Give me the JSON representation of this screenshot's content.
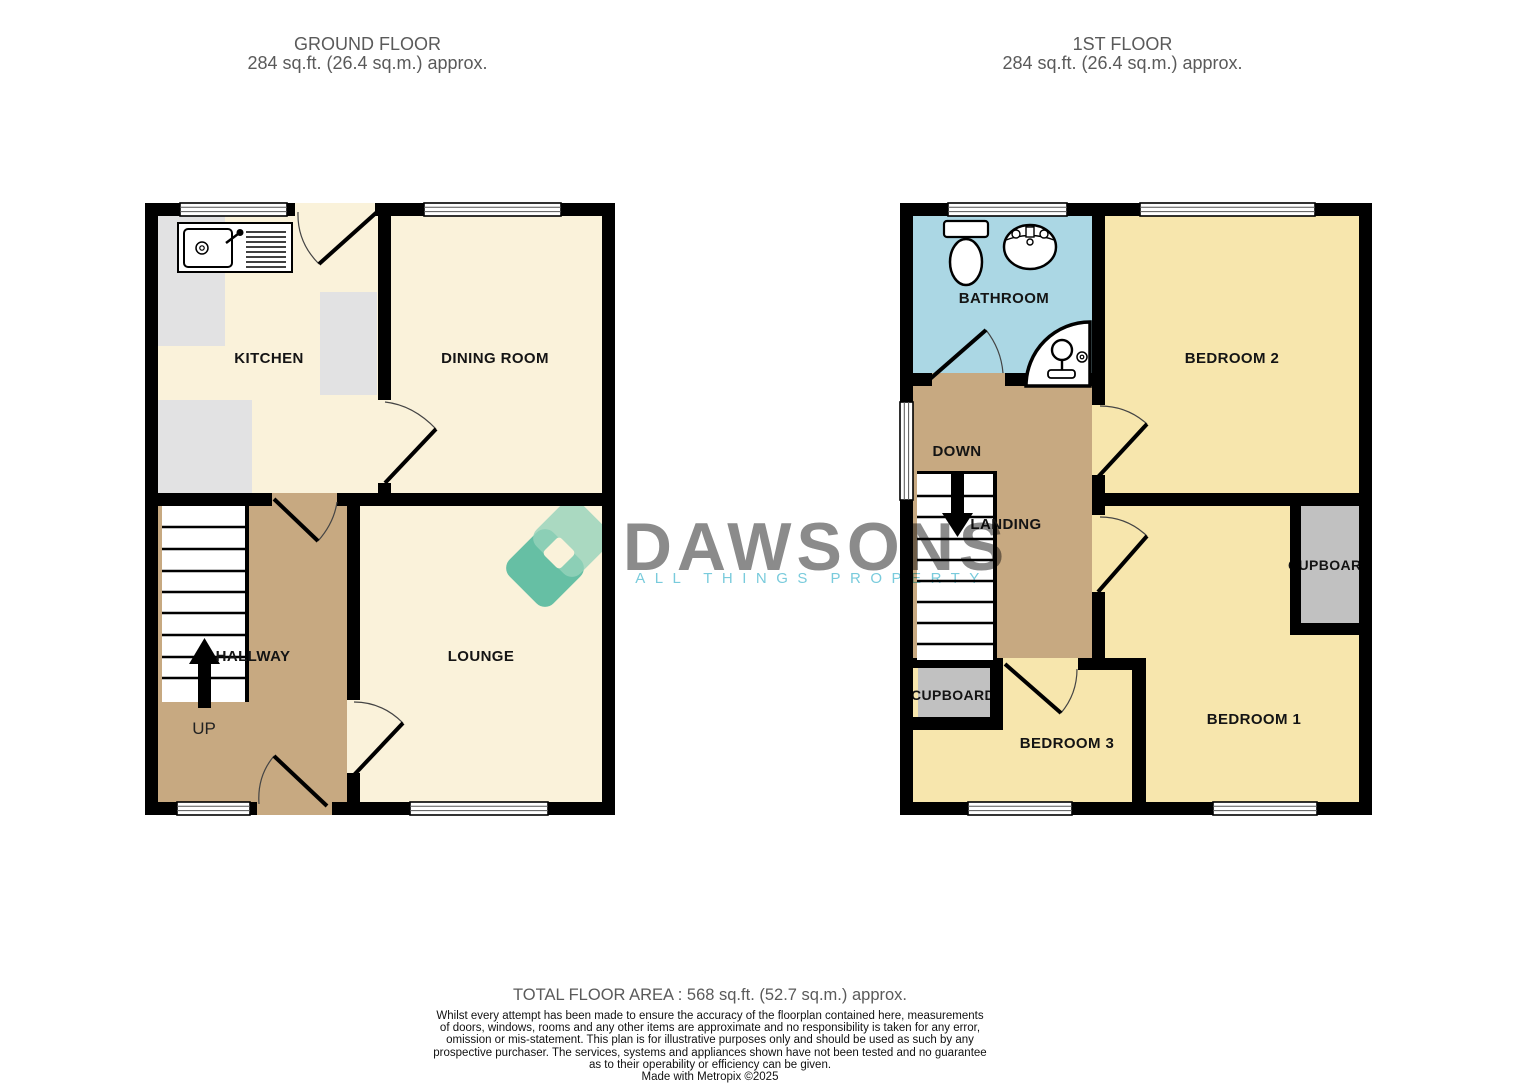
{
  "ground_floor": {
    "title": "GROUND FLOOR",
    "area": "284 sq.ft. (26.4 sq.m.) approx.",
    "rooms": {
      "kitchen": "KITCHEN",
      "dining": "DINING ROOM",
      "hallway": "HALLWAY",
      "lounge": "LOUNGE"
    },
    "stair_label": "UP"
  },
  "first_floor": {
    "title": "1ST FLOOR",
    "area": "284 sq.ft. (26.4 sq.m.) approx.",
    "rooms": {
      "bathroom": "BATHROOM",
      "bedroom2": "BEDROOM 2",
      "landing": "LANDING",
      "bedroom3": "BEDROOM 3",
      "bedroom1": "BEDROOM 1",
      "cupboard_left": "CUPBOARD",
      "cupboard_right": "CUPBOARD"
    },
    "stair_label": "DOWN"
  },
  "watermark": {
    "brand": "DAWSONS",
    "tagline": "ALL THINGS PROPERTY",
    "brand_color": "#8b8b8b",
    "tagline_color": "#79cbdc",
    "icon": "interlocking-diamonds",
    "icon_color_dark": "#4ec1b5",
    "icon_color_light": "#9adedb"
  },
  "footer": {
    "total_area": "TOTAL FLOOR AREA : 568 sq.ft. (52.7 sq.m.) approx.",
    "disclaimer_lines": [
      "Whilst every attempt has been made to ensure the accuracy of the floorplan contained here, measurements",
      "of doors, windows, rooms and any other items are approximate and no responsibility is taken for any error,",
      "omission or mis-statement. This plan is for illustrative purposes only and should be used as such by any",
      "prospective purchaser. The services, systems and appliances shown have not been tested and no guarantee",
      "as to their operability or efficiency can be given."
    ],
    "credit": "Made with Metropix ©2025"
  },
  "palette": {
    "wall": "#000000",
    "floor_cream": "#faf2da",
    "floor_yellow": "#f7e6ad",
    "floor_tan": "#c7a981",
    "floor_bath_blue": "#abd7e4",
    "counter_gray": "#e2e2e3",
    "cupboard_gray": "#c1c1c1"
  }
}
